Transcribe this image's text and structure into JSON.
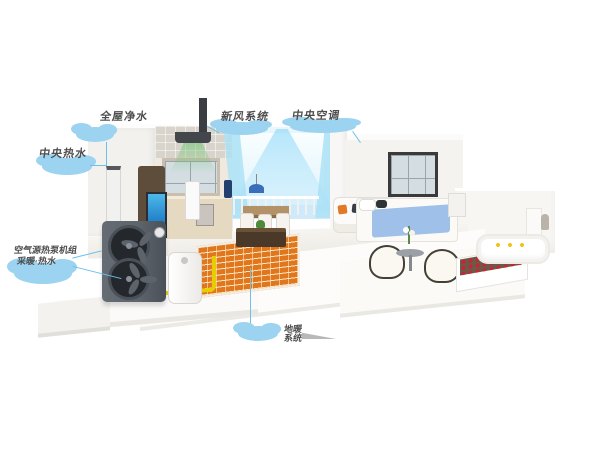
{
  "illustration": {
    "type": "smart-home heat pump system cutaway diagram",
    "background": "#ffffff"
  },
  "callouts": {
    "water_purifier": {
      "label": "全屋净水"
    },
    "fresh_air": {
      "label": "新风系统"
    },
    "central_ac": {
      "label": "中央空调"
    },
    "hot_water": {
      "label": "中央热水"
    },
    "heat_pump": {
      "line1": "空气源热泵机组",
      "line2": "采暖·热水"
    },
    "floor_heating": {
      "line1": "地暖",
      "line2": "系统"
    }
  },
  "colors": {
    "callout_cloud": "#9bd3f0",
    "callout_text": "#4d4d4d",
    "pointer_line": "#6cc0ea",
    "pipe_yellow": "#e6cf00",
    "floor_coil_orange": "#e0771c",
    "airflow_cool_blue": "#8fd8f8",
    "airflow_fresh_green": "#6cc46c",
    "heat_pump_body": "#5d636b",
    "bedding_blue": "#9fc0e8",
    "flowers_red": "#cc2233"
  }
}
